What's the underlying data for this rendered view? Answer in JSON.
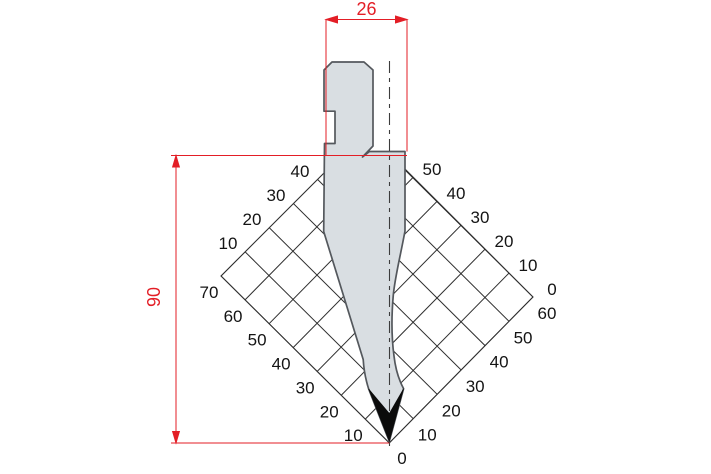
{
  "drawing": {
    "title": "press-brake punch profile with angle correction grid",
    "dimensions": {
      "width_label": "26",
      "height_label": "90"
    },
    "grid": {
      "labels_lower_left": [
        "10",
        "20",
        "30",
        "40",
        "50",
        "60",
        "70"
      ],
      "labels_lower_right": [
        "10",
        "20",
        "30",
        "40",
        "50",
        "60"
      ],
      "labels_upper_left": [
        "10",
        "20",
        "30",
        "40"
      ],
      "labels_upper_right": [
        "0",
        "10",
        "20",
        "30",
        "40",
        "50"
      ],
      "label_bottom": "0",
      "cells_lower_left": 7,
      "cells_lower_right": 6,
      "corner_bottom": [
        389.3,
        443
      ],
      "corner_left": [
        221,
        276
      ],
      "corner_right": [
        533,
        297
      ],
      "top_cut_y": 157
    },
    "colors": {
      "dimension_red": "#e31e26",
      "grid_line": "#2e2e2e",
      "label_text": "#141414",
      "punch_fill": "#d9dee2",
      "punch_outline": "#54585d",
      "tip_fill": "#0b0b0b",
      "center_line": "#3c3c3c",
      "background": "#ffffff"
    }
  }
}
